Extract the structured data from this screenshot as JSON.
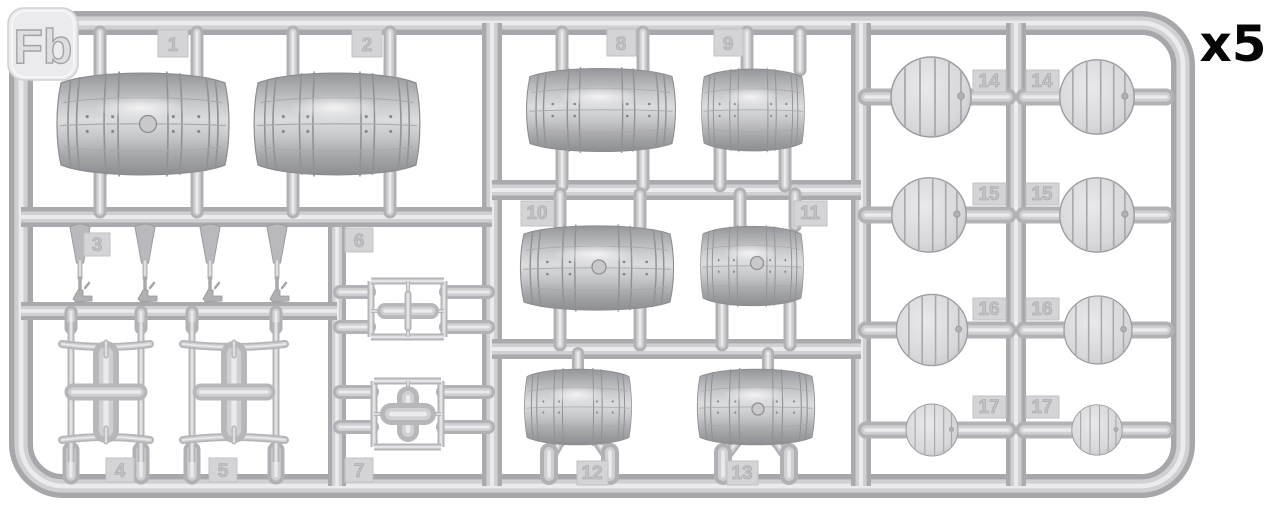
{
  "sprue": {
    "label": "Fb",
    "quantity": "x5"
  },
  "colors": {
    "plastic": "#c6c6ca",
    "plastic_highlight": "#e9e9eb",
    "plastic_shadow": "#8e8f93",
    "background": "#ffffff",
    "quantity_text": "#000000"
  },
  "tags": {
    "t1": "1",
    "t2": "2",
    "t3": "3",
    "t4": "4",
    "t5": "5",
    "t6": "6",
    "t7": "7",
    "t8": "8",
    "t9": "9",
    "t10": "10",
    "t11": "11",
    "t12": "12",
    "t13": "13",
    "t14a": "14",
    "t14b": "14",
    "t15a": "15",
    "t15b": "15",
    "t16a": "16",
    "t16b": "16",
    "t17a": "17",
    "t17b": "17"
  }
}
